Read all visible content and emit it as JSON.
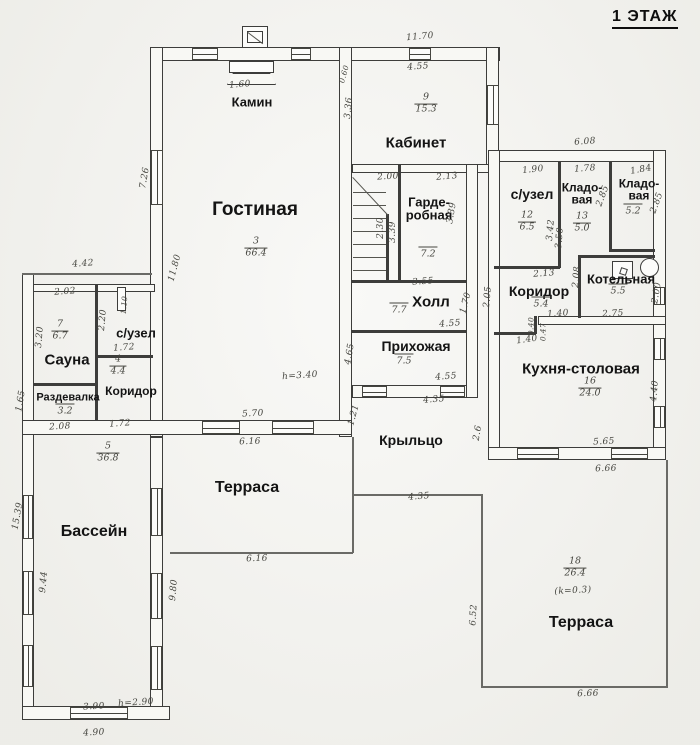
{
  "title": "1 ЭТАЖ",
  "colors": {
    "line": "#3d3d3b",
    "paper": "#f3f3ef",
    "text": "#141414"
  },
  "rooms": [
    {
      "name": "Гостиная",
      "x": 255,
      "y": 210,
      "fs": 19
    },
    {
      "name": "Камин",
      "x": 252,
      "y": 102,
      "fs": 13
    },
    {
      "name": "Кабинет",
      "x": 416,
      "y": 143,
      "fs": 15
    },
    {
      "name": "Гарде-\nробная",
      "x": 429,
      "y": 209,
      "fs": 13
    },
    {
      "name": "Холл",
      "x": 431,
      "y": 302,
      "fs": 15
    },
    {
      "name": "Прихожая",
      "x": 416,
      "y": 346,
      "fs": 14
    },
    {
      "name": "Крыльцо",
      "x": 411,
      "y": 440,
      "fs": 14
    },
    {
      "name": "с/узел",
      "x": 532,
      "y": 194,
      "fs": 14
    },
    {
      "name": "Кладо-\nвая",
      "x": 582,
      "y": 194,
      "fs": 12
    },
    {
      "name": "Кладо-\nвая",
      "x": 639,
      "y": 190,
      "fs": 12
    },
    {
      "name": "Коридор",
      "x": 539,
      "y": 291,
      "fs": 14
    },
    {
      "name": "Котельная",
      "x": 621,
      "y": 279,
      "fs": 13
    },
    {
      "name": "Кухня-столовая",
      "x": 581,
      "y": 369,
      "fs": 15
    },
    {
      "name": "Сауна",
      "x": 67,
      "y": 360,
      "fs": 15
    },
    {
      "name": "с/узел",
      "x": 136,
      "y": 333,
      "fs": 13
    },
    {
      "name": "Коридор",
      "x": 131,
      "y": 391,
      "fs": 12
    },
    {
      "name": "Раздевалка",
      "x": 68,
      "y": 398,
      "fs": 11
    },
    {
      "name": "Бассейн",
      "x": 94,
      "y": 532,
      "fs": 16
    },
    {
      "name": "Терраса",
      "x": 247,
      "y": 488,
      "fs": 16
    },
    {
      "name": "Терраса",
      "x": 581,
      "y": 623,
      "fs": 16
    }
  ],
  "room_numbers": [
    {
      "n": "3",
      "d": "66.4",
      "x": 256,
      "y": 248
    },
    {
      "n": "9",
      "d": "15.3",
      "x": 426,
      "y": 104
    },
    {
      "n": "12",
      "d": "6.5",
      "x": 527,
      "y": 222
    },
    {
      "n": "13",
      "d": "5.0",
      "x": 582,
      "y": 223
    },
    {
      "n": "16",
      "d": "24.0",
      "x": 590,
      "y": 388
    },
    {
      "n": "7",
      "d": "6.7",
      "x": 60,
      "y": 331
    },
    {
      "n": "4",
      "d": "4.4",
      "x": 118,
      "y": 366
    },
    {
      "n": "5",
      "d": "36.8",
      "x": 108,
      "y": 453
    },
    {
      "n": "18",
      "d": "26.4",
      "x": 575,
      "y": 568
    }
  ],
  "room_areas": [
    {
      "t": "7.2",
      "x": 428,
      "y": 253
    },
    {
      "t": "7.7",
      "x": 399,
      "y": 309
    },
    {
      "t": "7.5",
      "x": 404,
      "y": 360
    },
    {
      "t": "5.2",
      "x": 633,
      "y": 210
    },
    {
      "t": "5.4",
      "x": 541,
      "y": 303
    },
    {
      "t": "5.5",
      "x": 618,
      "y": 290
    },
    {
      "t": "3.2",
      "x": 65,
      "y": 410
    }
  ],
  "dims": [
    {
      "t": "11.70",
      "x": 420,
      "y": 37,
      "r": -5
    },
    {
      "t": "1.60",
      "x": 240,
      "y": 85,
      "r": -5
    },
    {
      "t": "0.60",
      "x": 344,
      "y": 74,
      "r": -75,
      "s": 1
    },
    {
      "t": "4.55",
      "x": 418,
      "y": 67,
      "r": -4
    },
    {
      "t": "7.26",
      "x": 145,
      "y": 178,
      "r": -80
    },
    {
      "t": "3.36",
      "x": 349,
      "y": 108,
      "r": -85
    },
    {
      "t": "6.08",
      "x": 585,
      "y": 142,
      "r": -4
    },
    {
      "t": "1.90",
      "x": 533,
      "y": 170,
      "r": -6
    },
    {
      "t": "1.78",
      "x": 585,
      "y": 169,
      "r": -4
    },
    {
      "t": "1.84",
      "x": 641,
      "y": 170,
      "r": -10
    },
    {
      "t": "2.00",
      "x": 388,
      "y": 177,
      "r": -3
    },
    {
      "t": "2.13",
      "x": 447,
      "y": 177,
      "r": -5
    },
    {
      "t": "2.30",
      "x": 381,
      "y": 228,
      "r": -90
    },
    {
      "t": "3.39",
      "x": 393,
      "y": 232,
      "r": -90
    },
    {
      "t": "3.39",
      "x": 452,
      "y": 213,
      "r": -80
    },
    {
      "t": "3.42",
      "x": 551,
      "y": 230,
      "r": -85
    },
    {
      "t": "3.50",
      "x": 560,
      "y": 238,
      "r": -85
    },
    {
      "t": "2.85",
      "x": 603,
      "y": 196,
      "r": -70
    },
    {
      "t": "2.85",
      "x": 657,
      "y": 203,
      "r": -70
    },
    {
      "t": "3.55",
      "x": 423,
      "y": 282,
      "r": -4
    },
    {
      "t": "2.13",
      "x": 544,
      "y": 274,
      "r": -4
    },
    {
      "t": "2.08",
      "x": 577,
      "y": 277,
      "r": -85
    },
    {
      "t": "2.05",
      "x": 488,
      "y": 297,
      "r": -85
    },
    {
      "t": "1.40",
      "x": 558,
      "y": 314,
      "r": -4
    },
    {
      "t": "2.75",
      "x": 613,
      "y": 314,
      "r": -3
    },
    {
      "t": "0.40",
      "x": 531,
      "y": 326,
      "r": -90,
      "s": 1
    },
    {
      "t": "0.47",
      "x": 543,
      "y": 332,
      "r": -90,
      "s": 1
    },
    {
      "t": "1.40",
      "x": 527,
      "y": 340,
      "r": -8
    },
    {
      "t": "2.00",
      "x": 657,
      "y": 293,
      "r": -80
    },
    {
      "t": "4.40",
      "x": 655,
      "y": 391,
      "r": -85
    },
    {
      "t": "5.65",
      "x": 604,
      "y": 442,
      "r": -3
    },
    {
      "t": "6.66",
      "x": 606,
      "y": 469,
      "r": -2
    },
    {
      "t": "4.55",
      "x": 450,
      "y": 324,
      "r": -4
    },
    {
      "t": "1.70",
      "x": 466,
      "y": 303,
      "r": -75
    },
    {
      "t": "4.65",
      "x": 350,
      "y": 354,
      "r": -80
    },
    {
      "t": "4.55",
      "x": 446,
      "y": 377,
      "r": -4
    },
    {
      "t": "4.35",
      "x": 434,
      "y": 400,
      "r": -5
    },
    {
      "t": "1.21",
      "x": 354,
      "y": 415,
      "r": -75
    },
    {
      "t": "2.6",
      "x": 478,
      "y": 433,
      "r": -80
    },
    {
      "t": "4.35",
      "x": 419,
      "y": 497,
      "r": -5
    },
    {
      "t": "6.52",
      "x": 474,
      "y": 615,
      "r": -87
    },
    {
      "t": "6.66",
      "x": 588,
      "y": 694,
      "r": -2
    },
    {
      "t": "5.70",
      "x": 253,
      "y": 414,
      "r": -3
    },
    {
      "t": "6.16",
      "x": 250,
      "y": 442,
      "r": -2
    },
    {
      "t": "6.16",
      "x": 257,
      "y": 559,
      "r": -2
    },
    {
      "t": "11.80",
      "x": 175,
      "y": 268,
      "r": -75
    },
    {
      "t": "4.42",
      "x": 83,
      "y": 264,
      "r": -4
    },
    {
      "t": "2.02",
      "x": 65,
      "y": 292,
      "r": -4
    },
    {
      "t": "3.20",
      "x": 40,
      "y": 337,
      "r": -85
    },
    {
      "t": "1.10",
      "x": 124,
      "y": 305,
      "r": -85,
      "s": 1
    },
    {
      "t": "2.20",
      "x": 103,
      "y": 320,
      "r": -85
    },
    {
      "t": "1.72",
      "x": 124,
      "y": 348,
      "r": -4
    },
    {
      "t": "1.72",
      "x": 120,
      "y": 424,
      "r": -4
    },
    {
      "t": "2.08",
      "x": 60,
      "y": 427,
      "r": -3
    },
    {
      "t": "1.65",
      "x": 21,
      "y": 401,
      "r": -80
    },
    {
      "t": "15.39",
      "x": 18,
      "y": 516,
      "r": -80
    },
    {
      "t": "9.44",
      "x": 44,
      "y": 582,
      "r": -85
    },
    {
      "t": "9.80",
      "x": 174,
      "y": 590,
      "r": -85
    },
    {
      "t": "3.90",
      "x": 94,
      "y": 707,
      "r": -3
    },
    {
      "t": "h=2.90",
      "x": 136,
      "y": 703,
      "r": -4
    },
    {
      "t": "4.90",
      "x": 94,
      "y": 733,
      "r": -3
    },
    {
      "t": "h=3.40",
      "x": 300,
      "y": 376,
      "r": -4
    },
    {
      "t": "(k=0.3)",
      "x": 573,
      "y": 591,
      "r": -3
    }
  ],
  "icons": [
    {
      "name": "boiler-icon"
    },
    {
      "name": "washing-machine-icon"
    },
    {
      "name": "fireplace-icon"
    },
    {
      "name": "chimney-icon"
    },
    {
      "name": "stairs-icon"
    }
  ]
}
